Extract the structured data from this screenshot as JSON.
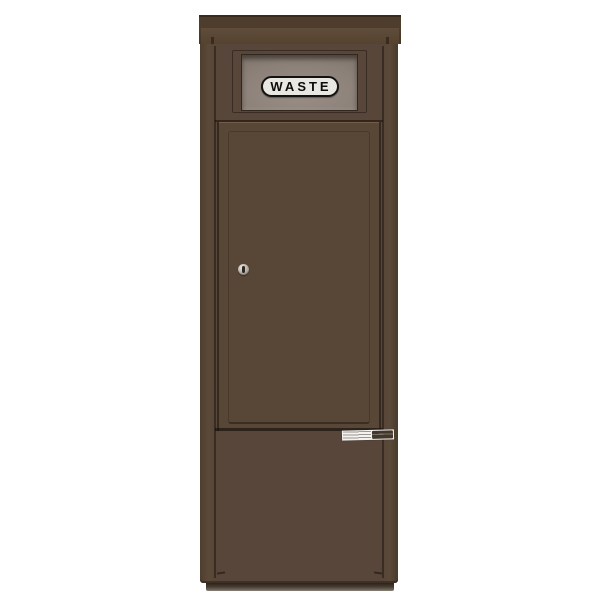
{
  "scene": {
    "background_color": "#ffffff",
    "object": "free-standing waste collection cabinet, antique bronze finish"
  },
  "sign": {
    "text": "WASTE",
    "background": "#e9e7e2",
    "border_color": "#14120f",
    "text_color": "#0d0c0a"
  },
  "colors": {
    "body_bronze": "#574639",
    "cap_dark_band": "#4e3d2d",
    "panel_gray": "#8b8078",
    "seam_dark": "#20180f",
    "lock_silver": "#b5afa7",
    "base_plinth": "#463b30",
    "sticker_white": "#f4f3f0"
  },
  "icons": {
    "lock": "keyhole-icon",
    "sticker_logo": "manufacturer-logo-icon"
  }
}
